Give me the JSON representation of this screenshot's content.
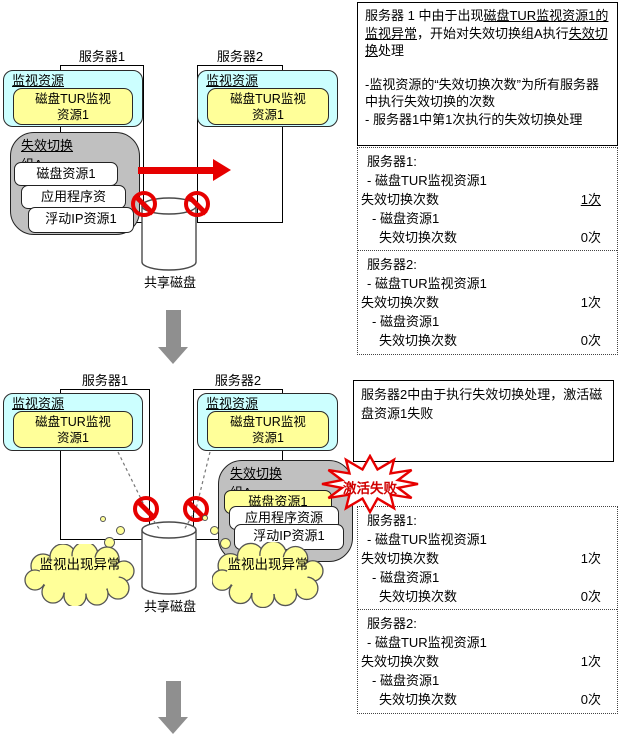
{
  "colors": {
    "monitor_cyan": "#ccffff",
    "resource_yellow": "#ffff99",
    "group_gray": "#c0c0c0",
    "alert_red": "#e60000",
    "arrow_gray": "#8f8f8f"
  },
  "diagrams": {
    "top": {
      "server1_label": "服务器1",
      "server2_label": "服务器2",
      "monitor_label": "监视资源",
      "monitor_resource": "磁盘TUR监视资源1",
      "group_label": "失效切换组A",
      "resources": [
        "磁盘资源1",
        "应用程序资",
        "浮动IP资源1"
      ],
      "shared_disk_label": "共享磁盘"
    },
    "bottom": {
      "server1_label": "服务器1",
      "server2_label": "服务器2",
      "monitor_label": "监视资源",
      "monitor_resource": "磁盘TUR监视资源1",
      "group_label": "失效切换组A",
      "resources": [
        "磁盘资源1",
        "应用程序资源",
        "浮动IP资源1"
      ],
      "shared_disk_label": "共享磁盘",
      "cloud1": "监视出现异常",
      "cloud2": "监视出现异常",
      "burst_label": "激活失败"
    }
  },
  "panels": {
    "top_note": {
      "intro_runs": [
        {
          "text": "服务器 1 中由于出现",
          "underline": false
        },
        {
          "text": "磁盘TUR监视资源1的监视异常",
          "underline": true
        },
        {
          "text": "，开始对失效切换组A执行",
          "underline": false
        },
        {
          "text": "失效切换",
          "underline": true
        },
        {
          "text": "处理",
          "underline": false
        }
      ],
      "bullets": [
        "-监视资源的“失效切换次数”为所有服务器中执行失效切换的次数",
        "- 服务器1中第1次执行的失效切换处理"
      ]
    },
    "bottom_note": "服务器2中由于执行失效切换处理，激活磁盘资源1失败",
    "stats_top": {
      "sections": [
        {
          "title": "服务器1:",
          "lines": [
            {
              "text": "- 磁盘TUR监视资源1",
              "indent": 1
            },
            {
              "text": "失效切换次数",
              "value": "1次",
              "underline_value": true,
              "indent": 0
            },
            {
              "text": "- 磁盘资源1",
              "indent": 2
            },
            {
              "text": "失效切换次数",
              "value": "0次",
              "indent": 3
            }
          ]
        },
        {
          "title": "服务器2:",
          "lines": [
            {
              "text": "- 磁盘TUR监视资源1",
              "indent": 1
            },
            {
              "text": "失效切换次数",
              "value": "1次",
              "indent": 0
            },
            {
              "text": "- 磁盘资源1",
              "indent": 2
            },
            {
              "text": "失效切换次数",
              "value": "0次",
              "indent": 3
            }
          ]
        }
      ]
    },
    "stats_bottom": {
      "sections": [
        {
          "title": "服务器1:",
          "lines": [
            {
              "text": "- 磁盘TUR监视资源1",
              "indent": 1
            },
            {
              "text": "失效切换次数",
              "value": "1次",
              "indent": 0
            },
            {
              "text": "- 磁盘资源1",
              "indent": 2
            },
            {
              "text": "失效切换次数",
              "value": "0次",
              "indent": 3
            }
          ]
        },
        {
          "title": "服务器2:",
          "lines": [
            {
              "text": "- 磁盘TUR监视资源1",
              "indent": 1
            },
            {
              "text": "失效切换次数",
              "value": "1次",
              "indent": 0
            },
            {
              "text": "- 磁盘资源1",
              "indent": 2
            },
            {
              "text": "失效切换次数",
              "value": "0次",
              "indent": 3
            }
          ]
        }
      ]
    }
  }
}
